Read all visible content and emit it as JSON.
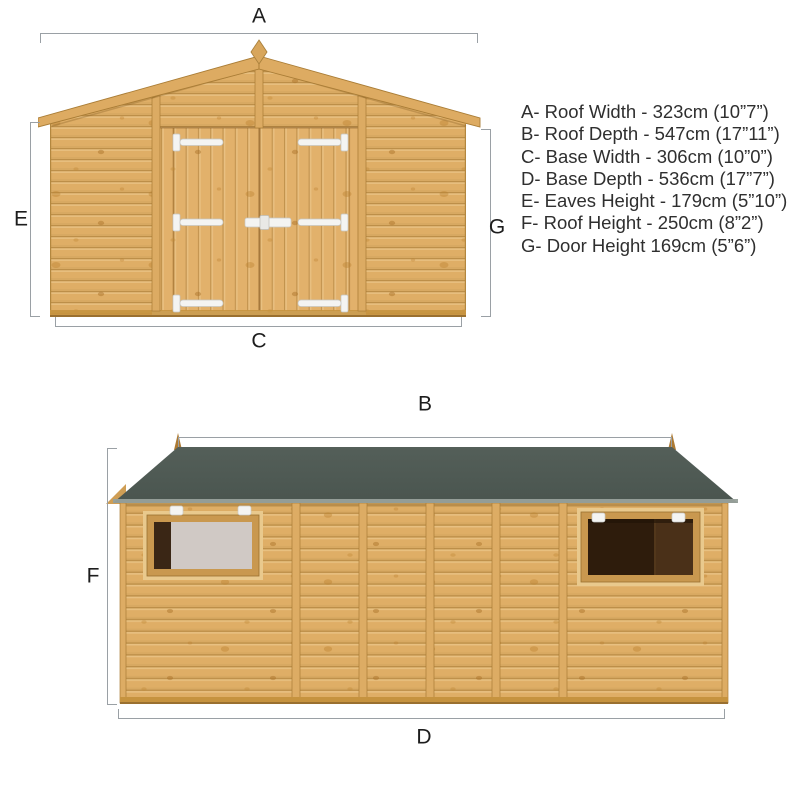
{
  "dims": {
    "a": "A",
    "b": "B",
    "c": "C",
    "d": "D",
    "e": "E",
    "f": "F",
    "g": "G"
  },
  "specs": {
    "items": [
      {
        "label": "A- Roof Width - 323cm (10”7”)"
      },
      {
        "label": "B- Roof Depth - 547cm (17”11”)"
      },
      {
        "label": "C- Base Width - 306cm (10”0”)"
      },
      {
        "label": "D- Base Depth - 536cm (17”7”)"
      },
      {
        "label": "E- Eaves Height - 179cm (5”10”)"
      },
      {
        "label": "F- Roof Height - 250cm (8”2”)"
      },
      {
        "label": "G- Door Height 169cm (5”6”)"
      }
    ]
  },
  "colors": {
    "wood_base": "#dfae66",
    "wood_plank_shadow": "#9c6f2b",
    "wood_trim": "#dcab63",
    "roof_felt": "#4f5b55",
    "roof_edge": "#98a19b",
    "window_glass": "#d0c9c5",
    "window_interior_dark": "#2e1c0c",
    "hinge_white": "#f4f4f2",
    "dim_line": "#9aa0a5",
    "label_text": "#1d1d1d",
    "spec_text": "#2f2f2f"
  }
}
